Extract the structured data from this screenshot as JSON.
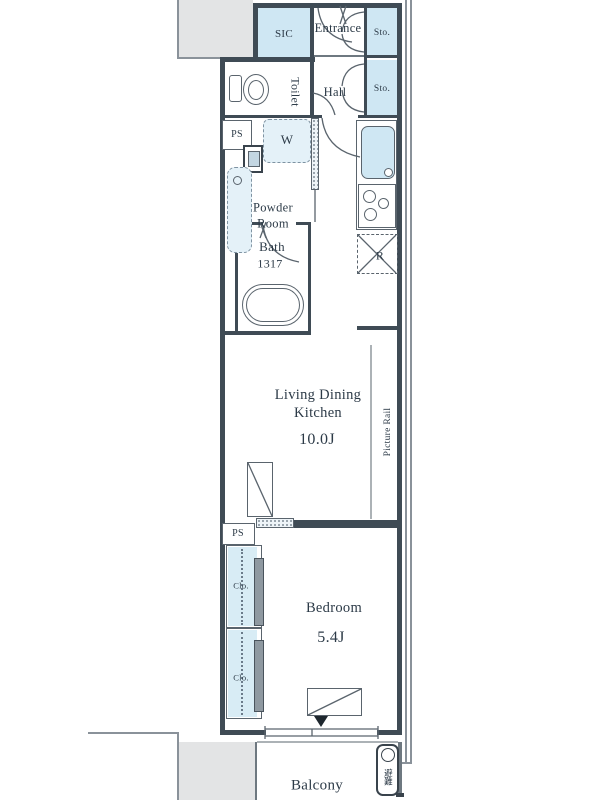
{
  "plan": {
    "title": "apartment-floor-plan",
    "rooms": {
      "sic": {
        "label": "SIC"
      },
      "entrance": {
        "label": "Entrance"
      },
      "storage_upper": {
        "label": "Sto."
      },
      "storage_lower": {
        "label": "Sto."
      },
      "toilet": {
        "label": "Toilet"
      },
      "hall": {
        "label": "Hall"
      },
      "pipe_space_top": {
        "label": "PS"
      },
      "washer": {
        "label": "W"
      },
      "powder_room": {
        "label": "Powder Room"
      },
      "bath": {
        "label": "Bath",
        "size": "1317"
      },
      "refrigerator": {
        "label": "R"
      },
      "ldk": {
        "label": "Living Dining Kitchen",
        "size": "10.0J"
      },
      "picture_rail": {
        "label": "Picture Rail"
      },
      "pipe_space_mid": {
        "label": "PS"
      },
      "closet_upper": {
        "label": "Clo."
      },
      "closet_lower": {
        "label": "Clo."
      },
      "bedroom": {
        "label": "Bedroom",
        "size": "5.4J"
      },
      "balcony": {
        "label": "Balcony"
      },
      "evacuation_hatch": {
        "label": "避難"
      }
    },
    "colors": {
      "wall": "#3f4b55",
      "linework": "#5a646d",
      "fixture_fill": "#cfe7f3",
      "closet_fill": "#d8ecf5",
      "corridor_fill": "#e3e4e5",
      "text": "#2c3a47"
    }
  }
}
